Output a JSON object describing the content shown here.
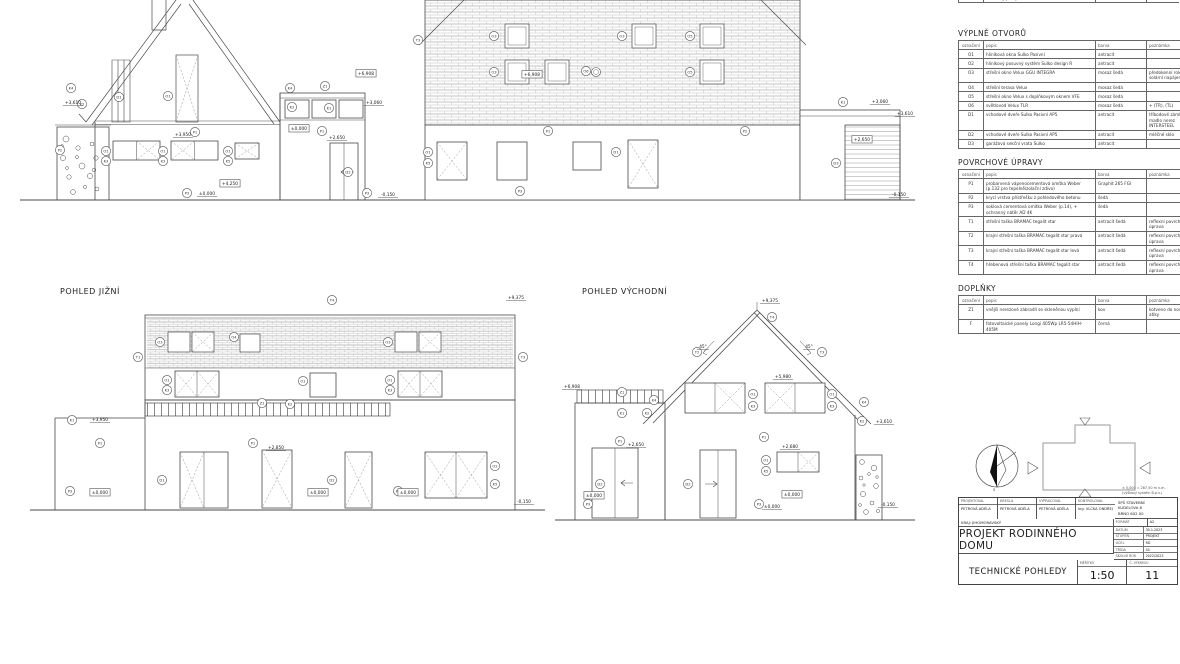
{
  "views": {
    "south": {
      "title": "POHLED JIŽNÍ"
    },
    "east": {
      "title": "POHLED VÝCHODNÍ"
    }
  },
  "legend": {
    "note1": "± 0,000 = 287,50 m n.m.",
    "note2": "(výškový systém B.p.v.)",
    "compass_letter": "S"
  },
  "tables": {
    "partial": {
      "rows": [
        [
          "",
          "",
          "",
          ""
        ],
        [
          "K5",
          "hliníkový parapet Sulko",
          "antracit",
          ""
        ]
      ]
    },
    "vyplne": {
      "title": "VÝPLNĚ OTVORŮ",
      "headers": [
        "označení",
        "popis",
        "barva",
        "poznámka"
      ],
      "rows": [
        [
          "O1",
          "hliníková okna Sulko Pasivní",
          "antracit",
          ""
        ],
        [
          "O2",
          "hliníkový posuvný systém Sulko design R",
          "antracit",
          ""
        ],
        [
          "O3",
          "střešní okno Velux GGU INTEGRA",
          "mosaz šedá",
          "předokenní roleta, solární napájení"
        ],
        [
          "O4",
          "střešní terasa Velux",
          "mosaz šedá",
          ""
        ],
        [
          "O5",
          "střešní okno Velux s doplňkovým oknem VFE",
          "mosaz šedá",
          ""
        ],
        [
          "O6",
          "světlovod Velux TLR",
          "mosaz šedá",
          "+ (TR), (TL)"
        ],
        [
          "D1",
          "vchodové dveře Sulko Pasivní AP5",
          "antracit",
          "tříbodové zámky, madlo nerez INTERSTEEL"
        ],
        [
          "D2",
          "vchodové dveře Sulko Pasivní AP5",
          "antracit",
          "mléčné sklo"
        ],
        [
          "D3",
          "garážová sekční vrata Sulko",
          "antracit",
          ""
        ]
      ]
    },
    "povrchove": {
      "title": "POVRCHOVÉ ÚPRAVY",
      "headers": [
        "označení",
        "popis",
        "barva",
        "poznámka"
      ],
      "rows": [
        [
          "P1",
          "probarvená vápenocementová omítka Weber (p.132 pro tepelněizolační zdivo)",
          "Graphit 265 FGI",
          ""
        ],
        [
          "P2",
          "krycí vrstva přístřešku z pohledového betonu",
          "šedá",
          ""
        ],
        [
          "P3",
          "soklová cementová omítka Weber (p.14), + ochranný nátěr AD 4K",
          "šedá",
          ""
        ],
        [
          "T1",
          "střešní taška BRAMAC tegalit star",
          "antracit šedá",
          "reflexní povrchová úprava"
        ],
        [
          "T2",
          "krajní střešní taška BRAMAC tegalit star pravá",
          "antracit šedá",
          "reflexní povrchová úprava"
        ],
        [
          "T3",
          "krajní střešní taška BRAMAC tegalit star levá",
          "antracit šedá",
          "reflexní povrchová úprava"
        ],
        [
          "T4",
          "hřebenová střešní taška BRAMAC tegalit star",
          "antracit šedá",
          "reflexní povrchová úprava"
        ]
      ]
    },
    "doplnky": {
      "title": "DOPLŇKY",
      "headers": [
        "označení",
        "popis",
        "barva",
        "poznámka"
      ],
      "rows": [
        [
          "Z1",
          "vnější nerezové zábradlí se skleněnou výplní",
          "kov",
          "kotveno do nosné atiky"
        ],
        [
          "F",
          "fotovoltaické panely Longi 405Wp LR5-54HIH-405M",
          "černá",
          ""
        ]
      ]
    }
  },
  "titleblock": {
    "people": [
      {
        "h": "PROJEKTOVAL",
        "v": "PETROVÁ ADÉLA"
      },
      {
        "h": "KRESLIL",
        "v": "PETROVÁ ADÉLA"
      },
      {
        "h": "VYPRACOVAL",
        "v": "PETROVÁ ADÉLA"
      },
      {
        "h": "KONTROLOVAL",
        "v": "Ing. VLČKA ONDŘEJ"
      }
    ],
    "school": [
      "SPŠ STAVEBNÍ",
      "KUDELOVA 8",
      "BRNO 602 00"
    ],
    "region": "KRAJ: JIHOMORAVSKÝ",
    "format_label": "FORMÁT",
    "format_value": "A2",
    "meta": [
      {
        "l": "DATUM",
        "v": "30.1.2023"
      },
      {
        "l": "STUPEŇ",
        "v": "PROJEKT"
      },
      {
        "l": "ÚČEL",
        "v": "RD"
      },
      {
        "l": "TŘÍDA",
        "v": "S4"
      },
      {
        "l": "ŠKOLNÍ ROK",
        "v": "2022/2023"
      }
    ],
    "project_title": "PROJEKT RODINNÉHO DOMU",
    "sheet_title": "TECHNICKÉ POHLEDY",
    "scale_label": "MĚŘÍTKO",
    "scale": "1:50",
    "number_label": "Č. VÝKRESU",
    "number": "11"
  },
  "elevations": {
    "west": {
      "markers": [
        {
          "x": 71,
          "y": 88,
          "t": "K4"
        },
        {
          "x": 82,
          "y": 104,
          "t": "K2"
        },
        {
          "x": 60,
          "y": 150,
          "t": "P2"
        },
        {
          "x": 119,
          "y": 97,
          "t": "D1"
        },
        {
          "x": 168,
          "y": 96,
          "t": "O1"
        },
        {
          "x": 106,
          "y": 151,
          "t": "O1"
        },
        {
          "x": 106,
          "y": 161,
          "t": "K3"
        },
        {
          "x": 163,
          "y": 151,
          "t": "O1"
        },
        {
          "x": 163,
          "y": 161,
          "t": "K3"
        },
        {
          "x": 228,
          "y": 151,
          "t": "O1"
        },
        {
          "x": 228,
          "y": 161,
          "t": "K5"
        },
        {
          "x": 195,
          "y": 132,
          "t": "P1"
        },
        {
          "x": 187,
          "y": 193,
          "t": "P3"
        },
        {
          "x": 290,
          "y": 88,
          "t": "K4"
        },
        {
          "x": 325,
          "y": 86,
          "t": "Z1"
        },
        {
          "x": 292,
          "y": 107,
          "t": "K2"
        },
        {
          "x": 329,
          "y": 108,
          "t": "K1"
        },
        {
          "x": 322,
          "y": 131,
          "t": "P1"
        },
        {
          "x": 348,
          "y": 172,
          "t": "D2"
        },
        {
          "x": 367,
          "y": 193,
          "t": "P3"
        }
      ],
      "levels": [
        {
          "x": 73,
          "y": 104,
          "t": "+3,610"
        },
        {
          "x": 183,
          "y": 136,
          "t": "+3,950"
        },
        {
          "x": 230,
          "y": 185,
          "t": "+4,250",
          "box": true
        },
        {
          "x": 207,
          "y": 195,
          "t": "±0,000"
        },
        {
          "x": 366,
          "y": 75,
          "t": "+6,908",
          "box": true
        },
        {
          "x": 374,
          "y": 104,
          "t": "+3,060"
        },
        {
          "x": 337,
          "y": 139,
          "t": "+2,650"
        },
        {
          "x": 299,
          "y": 130,
          "t": "±0,000",
          "box": true
        },
        {
          "x": 388,
          "y": 196,
          "t": "-0,150"
        }
      ]
    },
    "north": {
      "markers": [
        {
          "x": 418,
          "y": 40,
          "t": "T3"
        },
        {
          "x": 494,
          "y": 36,
          "t": "O3"
        },
        {
          "x": 622,
          "y": 36,
          "t": "O3"
        },
        {
          "x": 690,
          "y": 36,
          "t": "O5"
        },
        {
          "x": 494,
          "y": 72,
          "t": "O3"
        },
        {
          "x": 586,
          "y": 71,
          "t": "O6"
        },
        {
          "x": 690,
          "y": 72,
          "t": "O5"
        },
        {
          "x": 428,
          "y": 152,
          "t": "O1"
        },
        {
          "x": 428,
          "y": 163,
          "t": "K5"
        },
        {
          "x": 616,
          "y": 152,
          "t": "D1"
        },
        {
          "x": 548,
          "y": 131,
          "t": "P1"
        },
        {
          "x": 745,
          "y": 131,
          "t": "P2"
        },
        {
          "x": 520,
          "y": 191,
          "t": "P3"
        },
        {
          "x": 836,
          "y": 163,
          "t": "D3"
        },
        {
          "x": 843,
          "y": 102,
          "t": "K1"
        }
      ],
      "levels": [
        {
          "x": 532,
          "y": 76,
          "t": "+6,908",
          "box": true
        },
        {
          "x": 880,
          "y": 103,
          "t": "+3,060"
        },
        {
          "x": 905,
          "y": 115,
          "t": "+3,610"
        },
        {
          "x": 862,
          "y": 141,
          "t": "+2,650",
          "box": true
        },
        {
          "x": 899,
          "y": 196,
          "t": "-0,150"
        }
      ]
    },
    "south": {
      "markers": [
        {
          "x": 332,
          "y": 300,
          "t": "T4"
        },
        {
          "x": 138,
          "y": 357,
          "t": "T1"
        },
        {
          "x": 523,
          "y": 357,
          "t": "T3"
        },
        {
          "x": 160,
          "y": 342,
          "t": "O3"
        },
        {
          "x": 388,
          "y": 342,
          "t": "O3"
        },
        {
          "x": 234,
          "y": 337,
          "t": "O4"
        },
        {
          "x": 167,
          "y": 380,
          "t": "O1"
        },
        {
          "x": 167,
          "y": 390,
          "t": "K3"
        },
        {
          "x": 303,
          "y": 381,
          "t": "O1"
        },
        {
          "x": 390,
          "y": 380,
          "t": "O1"
        },
        {
          "x": 390,
          "y": 390,
          "t": "K3"
        },
        {
          "x": 262,
          "y": 403,
          "t": "Z1"
        },
        {
          "x": 290,
          "y": 404,
          "t": "K2"
        },
        {
          "x": 72,
          "y": 420,
          "t": "K1"
        },
        {
          "x": 100,
          "y": 443,
          "t": "P1"
        },
        {
          "x": 253,
          "y": 443,
          "t": "P1"
        },
        {
          "x": 162,
          "y": 480,
          "t": "D1"
        },
        {
          "x": 332,
          "y": 480,
          "t": "D2"
        },
        {
          "x": 495,
          "y": 466,
          "t": "O2"
        },
        {
          "x": 495,
          "y": 484,
          "t": "K5"
        },
        {
          "x": 70,
          "y": 491,
          "t": "P3"
        },
        {
          "x": 398,
          "y": 491,
          "t": "P3"
        }
      ],
      "levels": [
        {
          "x": 516,
          "y": 299,
          "t": "+9,375"
        },
        {
          "x": 100,
          "y": 421,
          "t": "+3,950"
        },
        {
          "x": 276,
          "y": 449,
          "t": "+2,850"
        },
        {
          "x": 100,
          "y": 494,
          "t": "±0,000",
          "box": true
        },
        {
          "x": 318,
          "y": 494,
          "t": "±0,000",
          "box": true
        },
        {
          "x": 408,
          "y": 494,
          "t": "±0,000",
          "box": true
        },
        {
          "x": 524,
          "y": 503,
          "t": "-0,150"
        }
      ]
    },
    "east": {
      "markers": [
        {
          "x": 697,
          "y": 352,
          "t": "T2"
        },
        {
          "x": 772,
          "y": 317,
          "t": "T4"
        },
        {
          "x": 822,
          "y": 352,
          "t": "T3"
        },
        {
          "x": 654,
          "y": 400,
          "t": "K4"
        },
        {
          "x": 864,
          "y": 402,
          "t": "K4"
        },
        {
          "x": 622,
          "y": 392,
          "t": "Z1"
        },
        {
          "x": 622,
          "y": 413,
          "t": "K1"
        },
        {
          "x": 647,
          "y": 413,
          "t": "K2"
        },
        {
          "x": 862,
          "y": 421,
          "t": "K2"
        },
        {
          "x": 753,
          "y": 394,
          "t": "O1"
        },
        {
          "x": 753,
          "y": 406,
          "t": "K3"
        },
        {
          "x": 832,
          "y": 394,
          "t": "O1"
        },
        {
          "x": 832,
          "y": 406,
          "t": "K3"
        },
        {
          "x": 600,
          "y": 484,
          "t": "D2"
        },
        {
          "x": 688,
          "y": 484,
          "t": "D2"
        },
        {
          "x": 766,
          "y": 460,
          "t": "O1"
        },
        {
          "x": 766,
          "y": 471,
          "t": "K5"
        },
        {
          "x": 620,
          "y": 441,
          "t": "P1"
        },
        {
          "x": 764,
          "y": 437,
          "t": "P1"
        },
        {
          "x": 588,
          "y": 504,
          "t": "P3"
        },
        {
          "x": 759,
          "y": 504,
          "t": "P3"
        }
      ],
      "levels": [
        {
          "x": 770,
          "y": 302,
          "t": "+9,375"
        },
        {
          "x": 703,
          "y": 348,
          "t": "45°"
        },
        {
          "x": 809,
          "y": 348,
          "t": "45°"
        },
        {
          "x": 572,
          "y": 388,
          "t": "+6,908"
        },
        {
          "x": 783,
          "y": 378,
          "t": "+5,980"
        },
        {
          "x": 636,
          "y": 446,
          "t": "+2,650"
        },
        {
          "x": 790,
          "y": 448,
          "t": "+2,680"
        },
        {
          "x": 884,
          "y": 423,
          "t": "+3,610"
        },
        {
          "x": 594,
          "y": 497,
          "t": "±0,000",
          "box": true
        },
        {
          "x": 792,
          "y": 496,
          "t": "±0,000",
          "box": true
        },
        {
          "x": 772,
          "y": 508,
          "t": "±0,000"
        },
        {
          "x": 888,
          "y": 506,
          "t": "-0,150"
        }
      ]
    }
  }
}
